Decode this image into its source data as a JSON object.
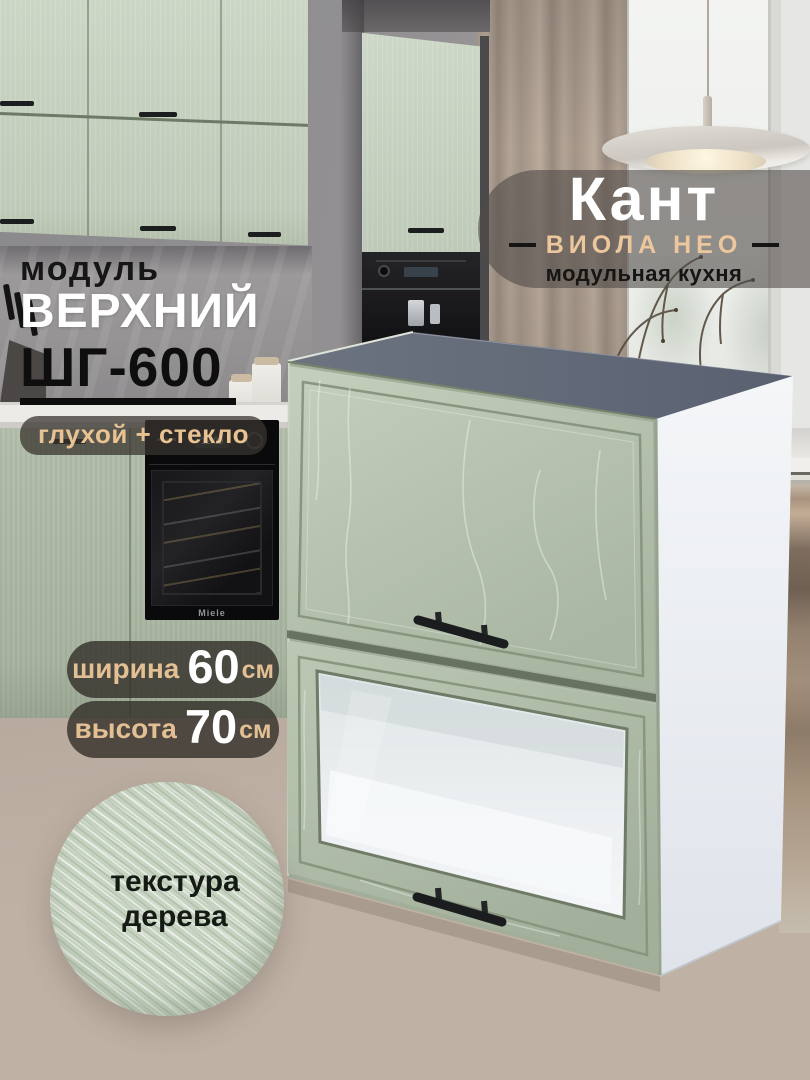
{
  "brand_badge": {
    "title": "Кант",
    "series": "ВИОЛА НЕО",
    "tagline": "модульная кухня"
  },
  "module_title": {
    "kicker": "модуль",
    "line1": "ВЕРХНИЙ",
    "line2": "ШГ-600",
    "config_badge": "глухой + стекло"
  },
  "dimensions": {
    "width": {
      "label": "ширина",
      "value": "60",
      "unit": "см"
    },
    "height": {
      "label": "высота",
      "value": "70",
      "unit": "см"
    }
  },
  "texture_badge": {
    "line1": "текстура",
    "line2": "дерева"
  },
  "appliances": {
    "oven_display": "12:00",
    "oven_brand": "Miele"
  },
  "colors": {
    "facade_green": "#b9c5b2",
    "top_panel_gray": "#666d79",
    "carcass_white": "#eef0f4",
    "accent_peach": "#e9c294",
    "badge_dark": "#302c27",
    "floor_taupe": "#b2a498",
    "text_dark": "#161514",
    "text_white": "#ffffff"
  }
}
